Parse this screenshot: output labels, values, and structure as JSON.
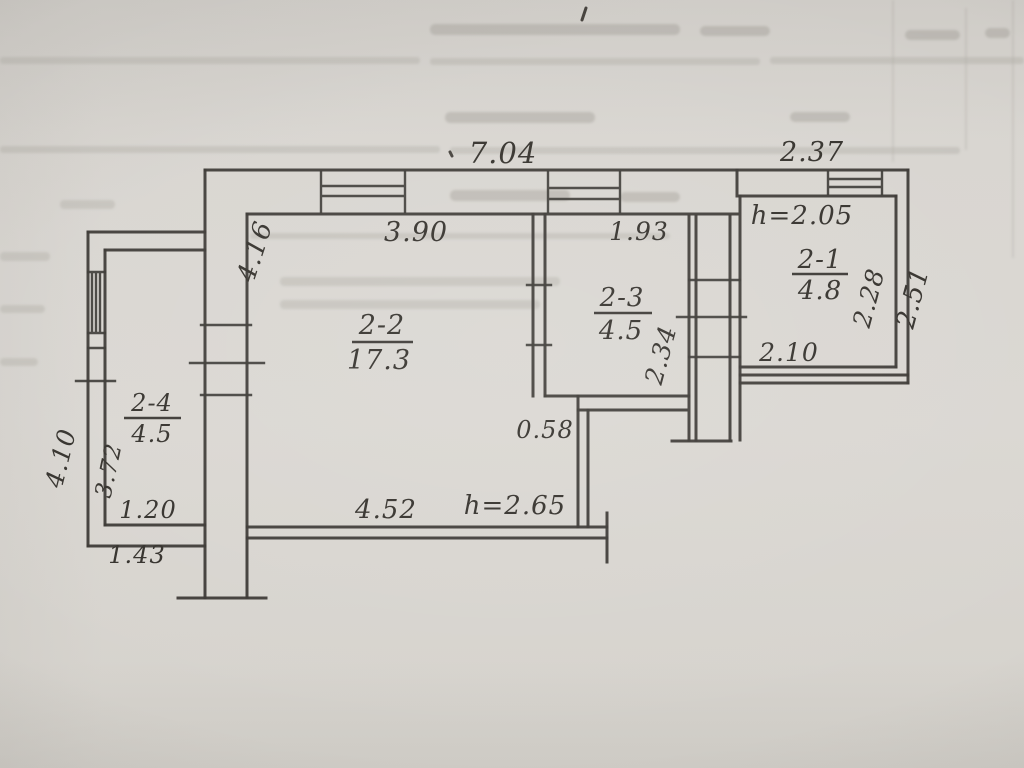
{
  "rooms": [
    {
      "id": "2-1",
      "area": "4.8"
    },
    {
      "id": "2-2",
      "area": "17.3"
    },
    {
      "id": "2-3",
      "area": "4.5"
    },
    {
      "id": "2-4",
      "area": "4.5"
    }
  ],
  "heights": {
    "right_room": "h=2.05",
    "main_room": "h=2.65"
  },
  "dims": {
    "top_width": "7.04",
    "top_right_width": "2.37",
    "room21_inner_side": "2.28",
    "right_outer_side": "2.51",
    "room21_bottom": "2.10",
    "room23_top": "1.93",
    "room22_top": "3.90",
    "room22_left_side": "4.16",
    "corridor_side": "2.34",
    "annex_outer_side": "4.10",
    "room24_inner_side": "3.72",
    "room24_bottom": "1.20",
    "annex_bottom": "1.43",
    "passage_step": "0.58",
    "bottom_width": "4.52"
  }
}
